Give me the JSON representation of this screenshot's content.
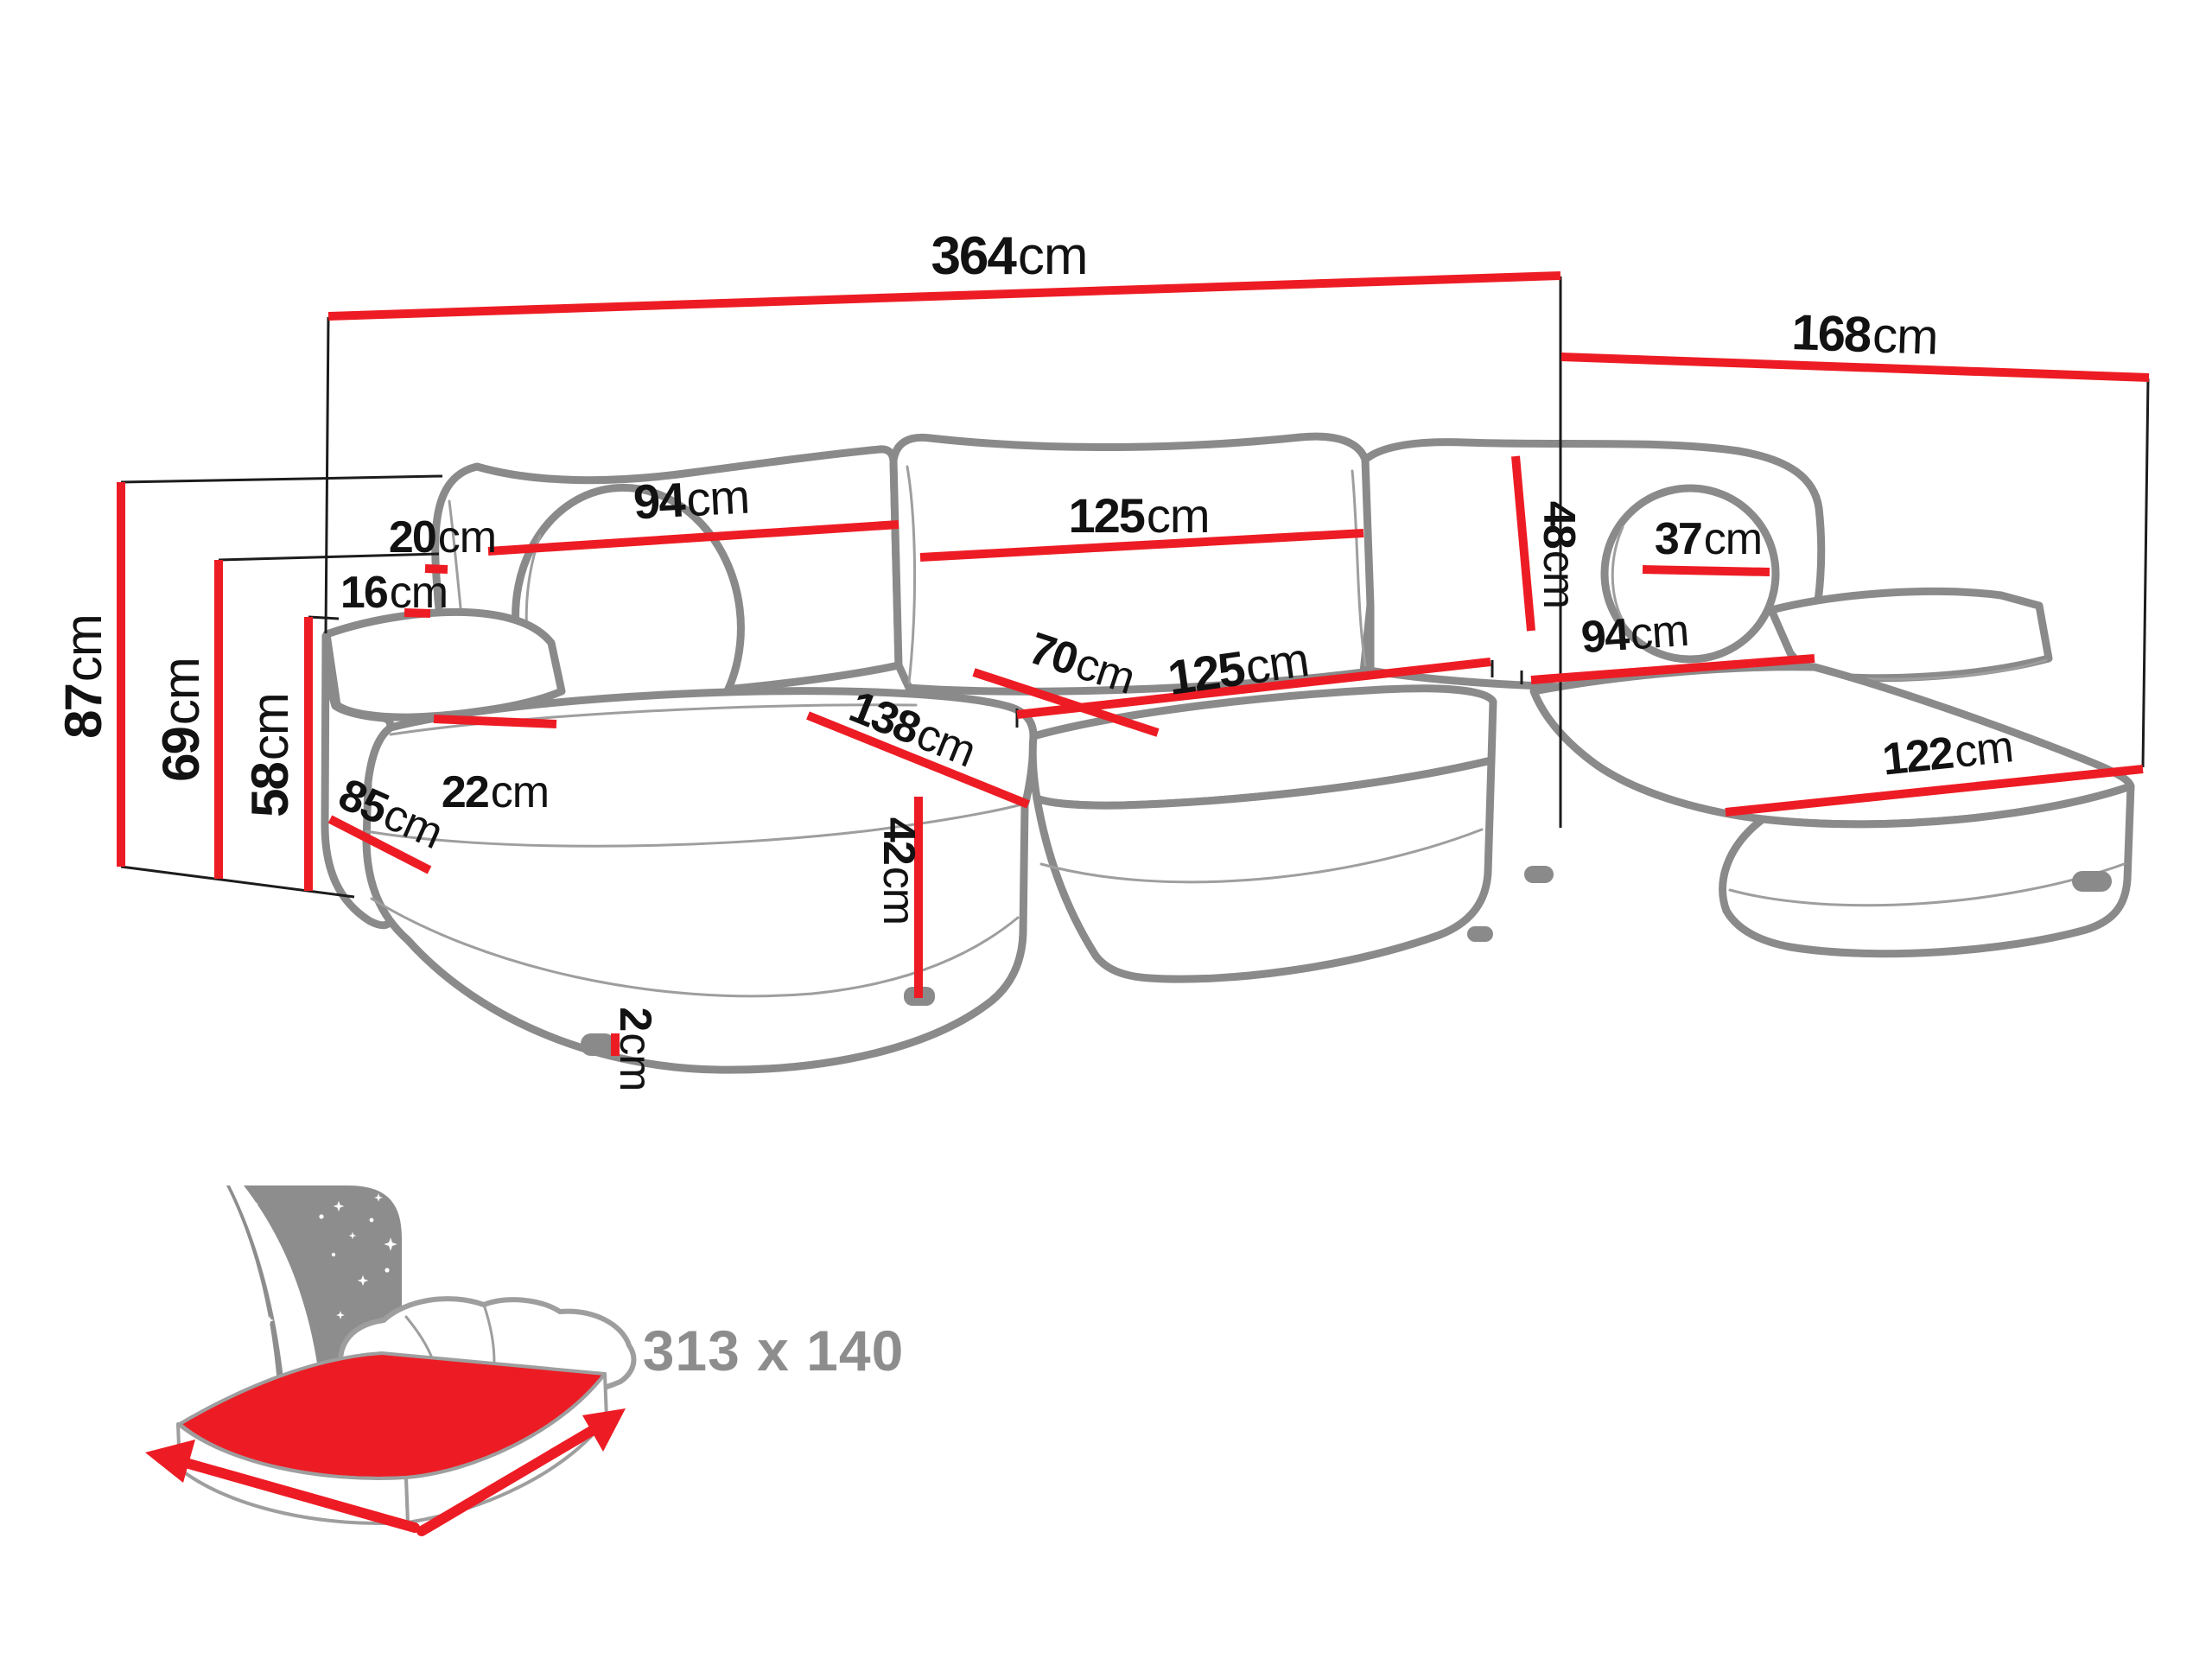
{
  "page": {
    "type": "sofa-dimension-diagram",
    "background": "#ffffff"
  },
  "colors": {
    "measure_line_red": "#ed1c24",
    "sofa_outline_gray": "#8a8a8a",
    "label_black": "#121212",
    "icon_gray": "#8d8d8d"
  },
  "measurements": {
    "overall_width": {
      "value": "364",
      "unit": "cm"
    },
    "overall_depth": {
      "value": "168",
      "unit": "cm"
    },
    "overall_height": {
      "value": "87",
      "unit": "cm"
    },
    "armrest_height": {
      "value": "69",
      "unit": "cm"
    },
    "seat_height": {
      "value": "58",
      "unit": "cm"
    },
    "backrest_left_width": {
      "value": "94",
      "unit": "cm"
    },
    "back_gap_top": {
      "value": "20",
      "unit": "cm"
    },
    "back_gap_bottom": {
      "value": "16",
      "unit": "cm"
    },
    "armrest_width": {
      "value": "22",
      "unit": "cm"
    },
    "armrest_depth": {
      "value": "85",
      "unit": "cm"
    },
    "chaise_left_length": {
      "value": "138",
      "unit": "cm"
    },
    "backrest_middle_width": {
      "value": "125",
      "unit": "cm"
    },
    "seat_depth": {
      "value": "70",
      "unit": "cm"
    },
    "seat_middle_width": {
      "value": "125",
      "unit": "cm"
    },
    "base_height": {
      "value": "42",
      "unit": "cm"
    },
    "leg_height": {
      "value": "2",
      "unit": "cm"
    },
    "backrest_cushion_height": {
      "value": "48",
      "unit": "cm"
    },
    "bolster_diameter": {
      "value": "37",
      "unit": "cm"
    },
    "seat_right_width": {
      "value": "94",
      "unit": "cm"
    },
    "chaise_right_length": {
      "value": "122",
      "unit": "cm"
    }
  },
  "sleeping_area": {
    "label": "313 x 140",
    "width_cm": "313",
    "depth_cm": "140"
  }
}
